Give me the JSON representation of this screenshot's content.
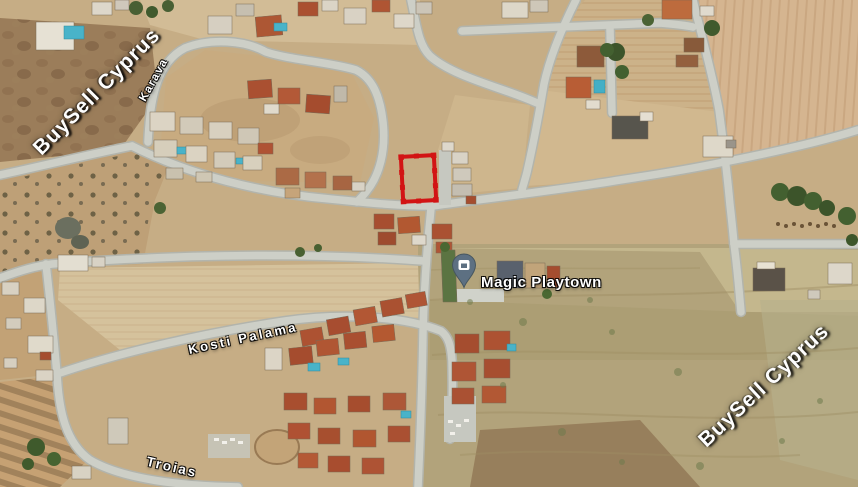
{
  "map": {
    "watermark": {
      "text": "BuySell Cyprus"
    },
    "streets": {
      "karava": "Karava",
      "kosti_palama": "Kosti Palama",
      "troias": "Troias"
    },
    "place": {
      "name": "Magic Playtown"
    },
    "plot": {
      "outline_color": "#d81212"
    }
  },
  "colors": {
    "plot-red": "#d81212",
    "pin-fill": "#5d7082",
    "pin-edge": "#46565f",
    "road-core": "#cdcfc7",
    "road-edge": "#b2b4ac",
    "label-text": "#ffffff"
  }
}
